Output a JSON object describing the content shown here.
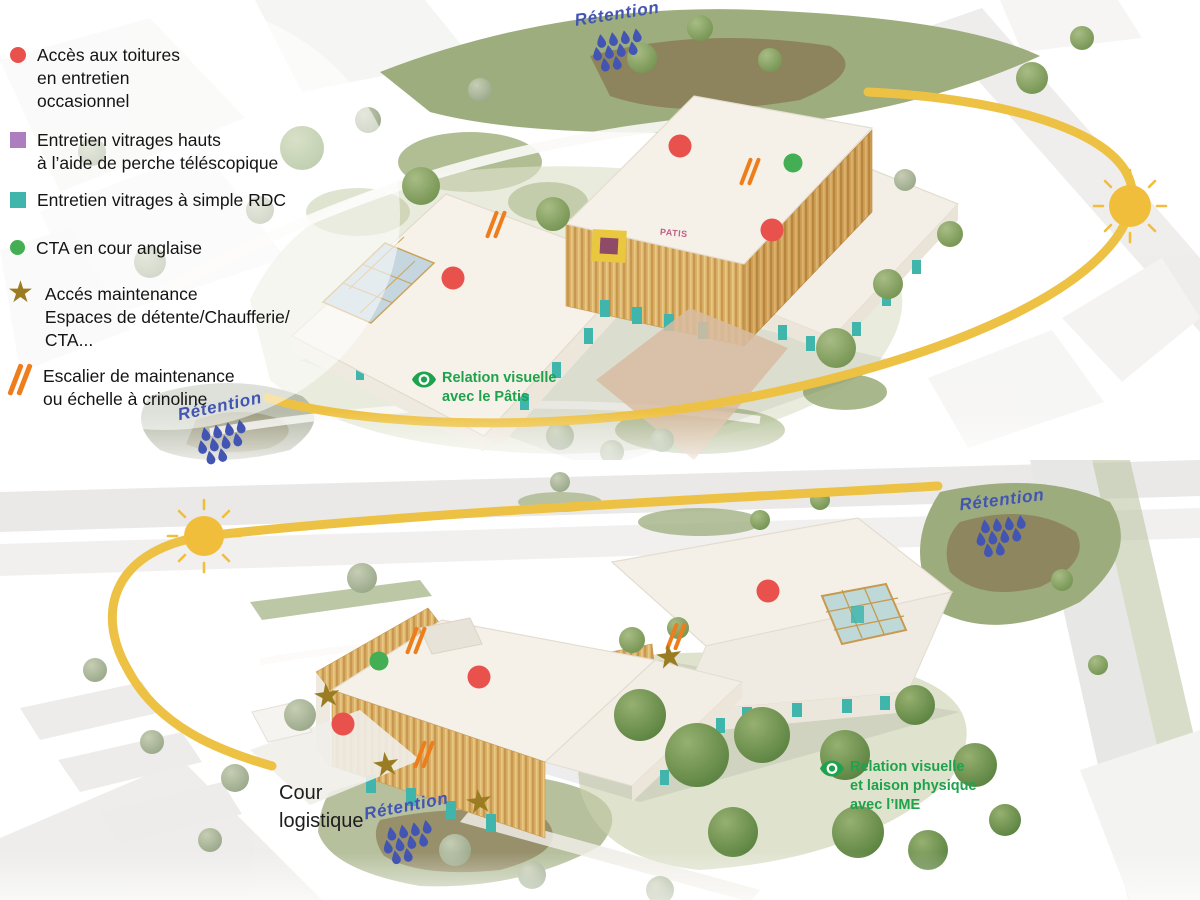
{
  "colors": {
    "sun": "#EDC244",
    "red": "#E9514D",
    "green": "#43AE54",
    "teal": "#3FB5AB",
    "purple": "#AC7EC0",
    "star": "#9A7D22",
    "orange": "#EE7D1C",
    "blue": "#4355B2",
    "note": "#1FA24C",
    "ink": "#1A1A1A"
  },
  "labels": {
    "retention": "Rétention"
  },
  "legend": {
    "items": [
      {
        "symbol": "red-circle",
        "lines": [
          "Accès aux toitures",
          "en entretien",
          "occasionnel"
        ]
      },
      {
        "symbol": "purple-square",
        "lines": [
          "Entretien vitrages hauts",
          "à l’aide de perche téléscopique"
        ]
      },
      {
        "symbol": "teal-square",
        "lines": [
          "Entretien vitrages à simple RDC"
        ]
      },
      {
        "symbol": "green-circle",
        "lines": [
          "CTA en cour anglaise"
        ]
      },
      {
        "symbol": "gold-star",
        "lines": [
          "Accés maintenance",
          "Espaces de détente/Chaufferie/",
          "CTA..."
        ]
      },
      {
        "symbol": "orange-slashes",
        "lines": [
          "Escalier de maintenance",
          "ou échelle à crinoline"
        ]
      }
    ]
  },
  "scenes": {
    "top": {
      "building_sign": "PATIS",
      "relation": {
        "line1": "Relation visuelle",
        "line2": "avec le Pâtis"
      },
      "markers": [
        {
          "type": "red-dot",
          "x": 453,
          "y": 278
        },
        {
          "type": "red-dot",
          "x": 680,
          "y": 146
        },
        {
          "type": "red-dot",
          "x": 772,
          "y": 230
        },
        {
          "type": "green-dot",
          "x": 793,
          "y": 163
        },
        {
          "type": "slashes",
          "x": 498,
          "y": 225
        },
        {
          "type": "slashes",
          "x": 752,
          "y": 172
        }
      ]
    },
    "bottom": {
      "cour": {
        "line1": "Cour",
        "line2": "logistique"
      },
      "relation": {
        "line1": "Relation visuelle",
        "line2": "et laison physique",
        "line3": "avec l’IME"
      },
      "markers": [
        {
          "type": "slashes",
          "x": 418,
          "y": 641
        },
        {
          "type": "green-dot",
          "x": 379,
          "y": 661
        },
        {
          "type": "star",
          "x": 327,
          "y": 697
        },
        {
          "type": "red-dot",
          "x": 343,
          "y": 724
        },
        {
          "type": "red-dot",
          "x": 479,
          "y": 677
        },
        {
          "type": "slashes",
          "x": 426,
          "y": 755
        },
        {
          "type": "star",
          "x": 386,
          "y": 766
        },
        {
          "type": "star",
          "x": 479,
          "y": 803
        },
        {
          "type": "red-dot",
          "x": 768,
          "y": 591
        },
        {
          "type": "slashes",
          "x": 678,
          "y": 637
        },
        {
          "type": "star",
          "x": 669,
          "y": 658
        }
      ]
    }
  }
}
